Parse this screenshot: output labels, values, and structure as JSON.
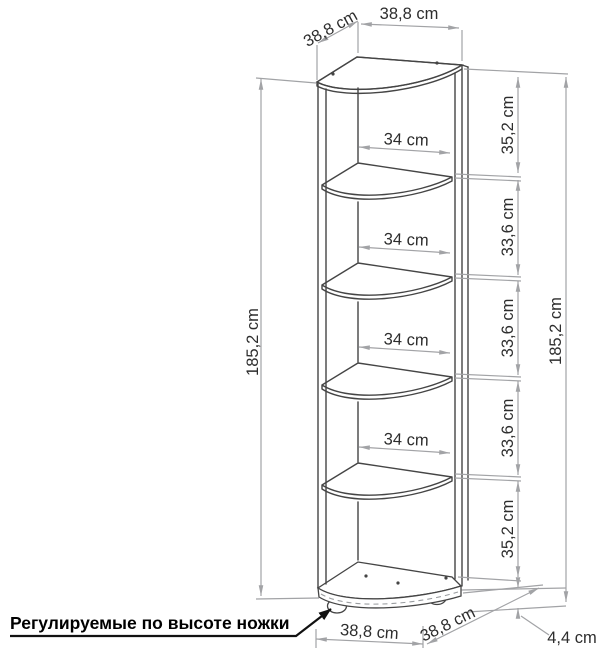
{
  "drawing": {
    "note": "Регулируемые по высоте ножки",
    "top": {
      "depth": "38,8 cm",
      "width": "38,8 cm"
    },
    "left": {
      "height": "185,2 cm"
    },
    "right": {
      "height": "185,2 cm",
      "gaps": [
        "35,2 cm",
        "33,6 cm",
        "33,6 cm",
        "33,6 cm",
        "35,2 cm"
      ]
    },
    "shelves": {
      "widths": [
        "34 cm",
        "34 cm",
        "34 cm",
        "34 cm"
      ]
    },
    "bottom": {
      "width": "38,8 cm",
      "depth": "38,8 cm",
      "feet": "4,4 cm"
    }
  },
  "colors": {
    "outline": "#454545",
    "dimension": "#a2a3a6",
    "label_text": "#2d2d2d",
    "note_text": "#000000",
    "background": "#ffffff"
  }
}
